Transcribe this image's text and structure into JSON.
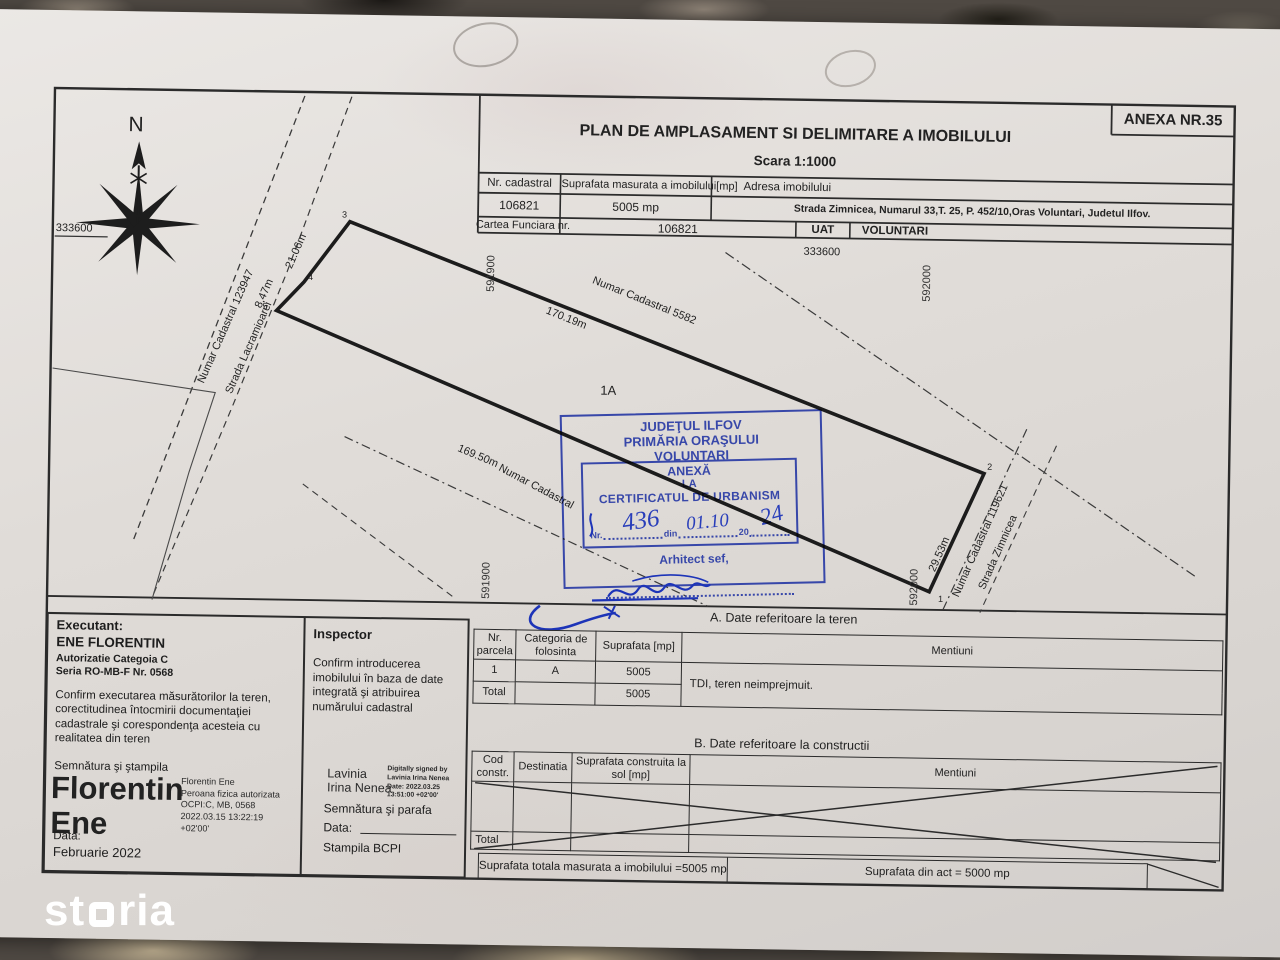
{
  "watermark": "storia",
  "sheet": {
    "anexa": "ANEXA NR.35",
    "title": "PLAN DE AMPLASAMENT SI DELIMITARE A IMOBILULUI",
    "scale": "Scara 1:1000",
    "id_table": {
      "col1_header": "Nr. cadastral",
      "col2_header": "Suprafata masurata a imobilului[mp]",
      "col3_header": "Adresa imobilului",
      "nr_cadastral": "106821",
      "suprafata": "5005 mp",
      "adresa": "Strada Zimnicea, Numarul 33,T. 25, P. 452/10,Oras Voluntari, Judetul Ilfov.",
      "cartea_label": "Cartea Funciara nr.",
      "cartea_value": "106821",
      "uat_label": "UAT",
      "uat_value": "VOLUNTARI"
    }
  },
  "plan": {
    "north": "N",
    "grid": {
      "y_333600_left": "333600",
      "y_333600_top": "333600",
      "x_591900_top": "591900",
      "x_591900_bottom": "591900",
      "x_592000_top": "592000",
      "x_592000_bottom": "592000"
    },
    "labels": {
      "neighbor_left_cadastral": "Numar Cadastral  123947",
      "neighbor_left_street": "Strada Lacramioarei",
      "len_21_06": "21.06m",
      "len_8_47": "8.47m",
      "neighbor_top_cadastral": "Numar Cadastral  5582",
      "len_170_19": "170.19m",
      "parcel_id": "1A",
      "len_169_50": "169.50m",
      "hidden_cadastral": "Numar Cadastral",
      "len_29_53": "29.53m",
      "neighbor_right_cadastral": "Numar Cadastral  119621",
      "neighbor_right_street": "Strada Zimnicea",
      "pt1": "1",
      "pt2": "2",
      "pt3": "3",
      "pt4": "4",
      "pt5": "5"
    }
  },
  "stamp": {
    "line1": "JUDEŢUL ILFOV",
    "line2": "PRIMĂRIA ORAŞULUI",
    "line3": "VOLUNTARI",
    "anexa1": "ANEXĂ",
    "anexa2": "LA",
    "anexa3": "CERTIFICATUL DE URBANISM",
    "nr_label": "Nr.",
    "din_label": "din",
    "year_prefix": "20",
    "hand_nr": "436",
    "hand_date": "01.10",
    "hand_year": "24",
    "arhitect": "Arhitect sef,",
    "color": "#2c3da6"
  },
  "executant": {
    "heading": "Executant:",
    "name": "ENE FLORENTIN",
    "aut1": "Autorizatie Categoia C",
    "aut2": "Seria RO-MB-F Nr. 0568",
    "confirm": "Confirm executarea măsurătorilor la teren, corectitudinea întocmirii documentaţiei cadastrale şi corespondenţa acesteia cu realitatea din teren",
    "semnatura": "Semnătura şi ştampila",
    "big_sig_1": "Florentin",
    "big_sig_2": "Ene",
    "sig_meta": [
      "Florentin Ene",
      "Peroana fizica autorizata",
      "OCPI:C, MB, 0568",
      "2022.03.15 13:22:19",
      "+02'00'"
    ],
    "data_label": "Data:",
    "data_value": "Februarie 2022"
  },
  "inspector": {
    "heading": "Inspector",
    "confirm": "Confirm introducerea imobilului în baza de date integrată şi atribuirea numărului cadastral",
    "sig_name_1": "Lavinia",
    "sig_name_2": "Irina Nenea",
    "sig_meta": [
      "Digitally signed by",
      "Lavinia Irina Nenea",
      "Date: 2022.03.25",
      "13:51:00 +02'00'"
    ],
    "semnatura": "Semnătura şi parafa",
    "data_label": "Data:",
    "stampila": "Stampila BCPI"
  },
  "section_a": {
    "title": "A. Date referitoare la teren",
    "headers": [
      "Nr. parcela",
      "Categoria de folosinta",
      "Suprafata [mp]",
      "Mentiuni"
    ],
    "rows": [
      [
        "1",
        "A",
        "5005"
      ],
      [
        "Total",
        "",
        "5005"
      ]
    ],
    "mentiuni": "TDI, teren neimprejmuit."
  },
  "section_b": {
    "title": "B. Date referitoare la constructii",
    "headers": [
      "Cod constr.",
      "Destinatia",
      "Suprafata construita la sol [mp]",
      "Mentiuni"
    ],
    "total_label": "Total"
  },
  "totals": {
    "measured": "Suprafata totala masurata a imobilului =5005 mp",
    "act": "Suprafata din act = 5000 mp"
  }
}
